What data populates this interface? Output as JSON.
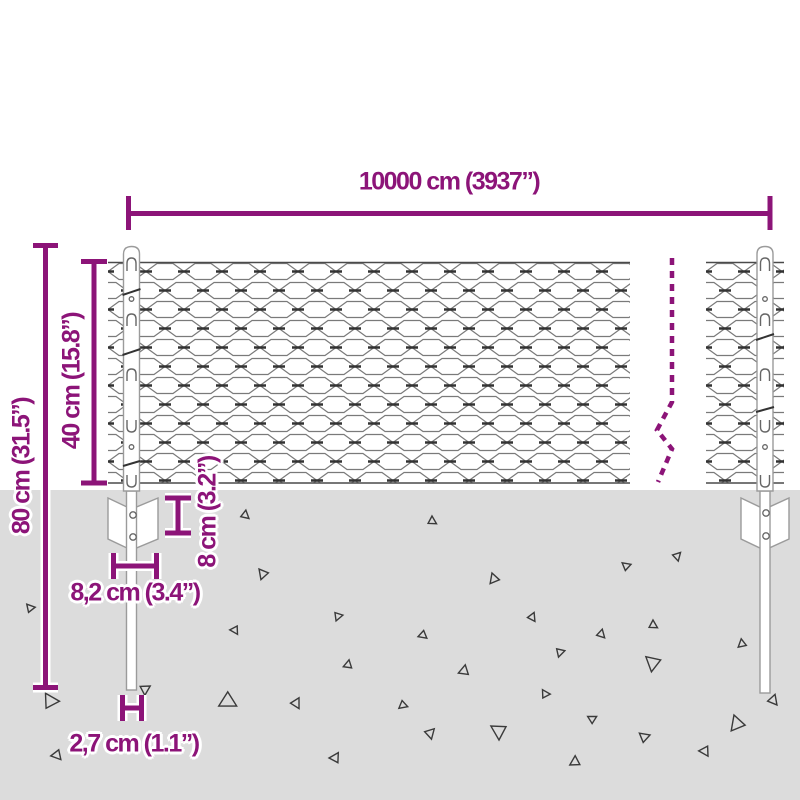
{
  "title": "Chain-link fence with posts — dimension diagram",
  "colors": {
    "accent": "#8c1478",
    "ground": "#dcdcdc",
    "mesh_line": "#7a7a7a",
    "mesh_twist": "#333333",
    "wire": "#4a4a4a",
    "post_outline": "#9b9b9b",
    "clip": "#666666",
    "triangle_line": "#3a3a3a"
  },
  "dimensions": {
    "total_width": {
      "label": "10000 cm (3937”)"
    },
    "post_height": {
      "label": "80 cm (31.5”)"
    },
    "mesh_height": {
      "label": "40 cm (15.8”)"
    },
    "anchor_depth": {
      "label": "8 cm (3.2”)"
    },
    "anchor_width": {
      "label": "8,2 cm (3.4”)"
    },
    "post_width": {
      "label": "2,7 cm (1.1”)"
    }
  },
  "ground": {
    "triangles": [
      [
        245,
        515,
        5,
        10
      ],
      [
        263,
        574,
        6,
        200
      ],
      [
        30,
        608,
        5,
        320
      ],
      [
        338,
        616,
        5,
        80
      ],
      [
        235,
        630,
        5,
        150
      ],
      [
        348,
        665,
        5,
        250
      ],
      [
        50,
        701,
        9,
        330
      ],
      [
        145,
        689,
        6,
        60
      ],
      [
        228,
        701,
        10,
        120
      ],
      [
        296,
        703,
        6,
        30
      ],
      [
        57,
        755,
        6,
        140
      ],
      [
        335,
        758,
        6,
        270
      ],
      [
        432,
        521,
        5,
        0
      ],
      [
        677,
        556,
        5,
        45
      ],
      [
        626,
        566,
        5,
        310
      ],
      [
        494,
        579,
        6,
        220
      ],
      [
        532,
        617,
        5,
        25
      ],
      [
        653,
        625,
        5,
        0
      ],
      [
        423,
        635,
        5,
        130
      ],
      [
        601,
        634,
        5,
        15
      ],
      [
        742,
        644,
        5,
        230
      ],
      [
        560,
        652,
        5,
        75
      ],
      [
        653,
        663,
        9,
        190
      ],
      [
        464,
        671,
        6,
        250
      ],
      [
        545,
        694,
        5,
        330
      ],
      [
        773,
        700,
        6,
        20
      ],
      [
        403,
        705,
        5,
        110
      ],
      [
        592,
        719,
        5,
        300
      ],
      [
        737,
        724,
        9,
        220
      ],
      [
        430,
        733,
        6,
        45
      ],
      [
        499,
        731,
        9,
        180
      ],
      [
        644,
        737,
        6,
        310
      ],
      [
        705,
        751,
        6,
        150
      ],
      [
        575,
        762,
        6,
        240
      ]
    ]
  }
}
